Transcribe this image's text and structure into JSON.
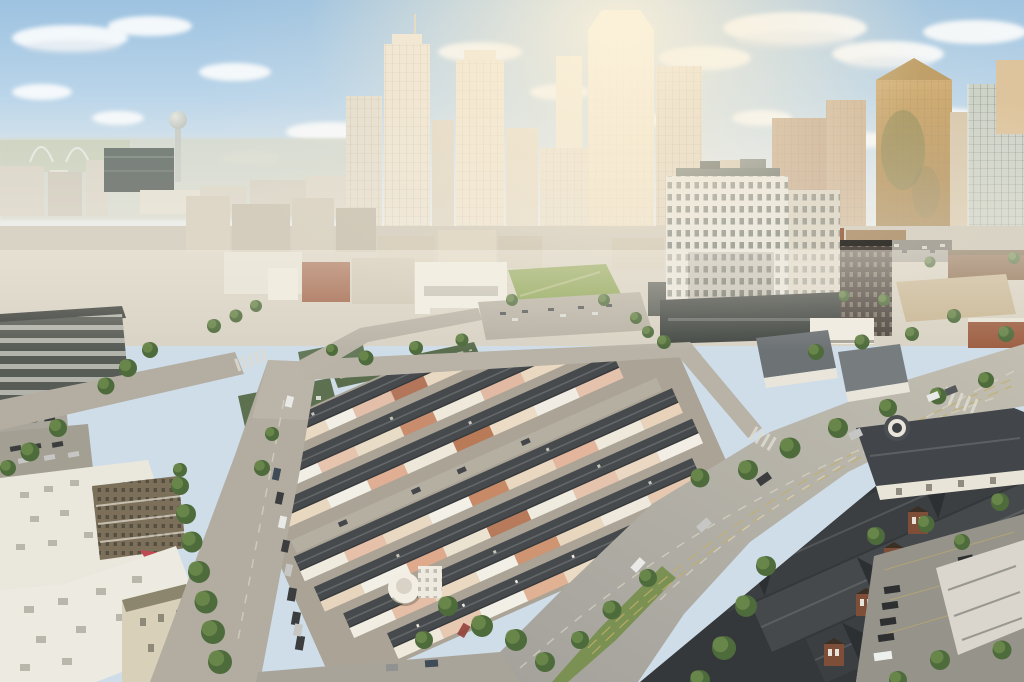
{
  "image": {
    "kind": "aerial-photograph",
    "width_px": 1024,
    "height_px": 682,
    "time_of_day": "late afternoon, hazy sun from upper right"
  },
  "scene": {
    "aria_label": "Aerial drone photograph of a hazy downtown skyline at golden hour with Reunion Tower on the left, a white high-rise apartment tower at center right, blocks of dark-roofed townhomes with cream and pink facades in the foreground, wide diagonal streets lined with trees and parked cars, green market sheds, parking lots, and a dark-roofed brick townhome complex in the lower right.",
    "description": "Daytime aerial view over an urban neighborhood looking toward a dense skyscraper skyline. Atmospheric haze and warm sun glow wash out the upper half. Foreground shows townhome blocks, boulevards with grass median, trees, cars and parking lots.",
    "palette": {
      "sky_top": "#9dc2e0",
      "sky_mid": "#b9d4e9",
      "sky_low": "#d9e6ef",
      "cloud_white": "#fafcfd",
      "sun_glow": "#fbf0d8",
      "haze": "#f3ede1",
      "far_skyline": "#ddd6c8",
      "tower_cream": "#ece3d1",
      "tower_gold": "#b08a4e",
      "glass_cool": "#cbd1c7",
      "dark_slab": "#5f6a66",
      "residential_white": "#ebe8df",
      "podium_dark": "#434844",
      "midground_tan": "#d9d3c5",
      "brick_red": "#a2654a",
      "market_green": "#5d7050",
      "lawn_green": "#8ca554",
      "tree_green": "#4e6b3c",
      "tree_light": "#6d8a4c",
      "street_gray": "#b2ada0",
      "street_sunlit": "#c0bbae",
      "lane_yellow": "#c2ae6a",
      "roof_charcoal": "#464a4d",
      "facade_cream": "#ead9c2",
      "facade_pink": "#e7c4ae",
      "facade_white": "#f2efe6",
      "brick_tower": "#7e4e38",
      "complex_roof": "#3b3f42",
      "parking_gray": "#96938b",
      "median_grass": "#7b9153",
      "red_awning": "#c04a52"
    },
    "elements": [
      {
        "name": "sky",
        "label": "Pale blue sky with scattered white clouds"
      },
      {
        "name": "sun-glow",
        "label": "Warm hazy sun glow upper center-right"
      },
      {
        "name": "margaret-hunt-hill-bridge",
        "label": "White bridge arches on far left horizon"
      },
      {
        "name": "reunion-tower",
        "label": "Observation tower with ball top, left skyline"
      },
      {
        "name": "dark-slab-hotel",
        "label": "Dark glass slab hotel left of skyline"
      },
      {
        "name": "skyline-center",
        "label": "Cluster of cream hazy skyscrapers"
      },
      {
        "name": "gold-tower",
        "label": "Gold reflective tower with pyramid top, right"
      },
      {
        "name": "stepped-glass-tower",
        "label": "Stepped glass tower at far right"
      },
      {
        "name": "residential-tower",
        "label": "White 20-story apartment block, center right"
      },
      {
        "name": "midground-city",
        "label": "Low-rise beige buildings, lawn park and parking lots"
      },
      {
        "name": "market-sheds",
        "label": "Long green-roofed market sheds"
      },
      {
        "name": "townhome-block",
        "label": "Rows of dark-roofed townhomes, cream/pink/brick facades"
      },
      {
        "name": "boulevard",
        "label": "Wide diagonal boulevard with grass median and lane lines"
      },
      {
        "name": "side-street",
        "label": "Tree-lined street with parked cars, left foreground"
      },
      {
        "name": "bottom-left-building",
        "label": "White flat-roof apartment building with AC units and red awning"
      },
      {
        "name": "bottom-right-complex",
        "label": "Dark zig-zag roofed complex with brick stair towers"
      },
      {
        "name": "parking-lot",
        "label": "Parking lot with cars and white van, lower right"
      },
      {
        "name": "trees",
        "label": "Street trees and garden shrubs"
      },
      {
        "name": "cars",
        "label": "Parked and moving cars"
      },
      {
        "name": "haze-overlay",
        "label": "Atmospheric haze band across skyline"
      }
    ]
  }
}
